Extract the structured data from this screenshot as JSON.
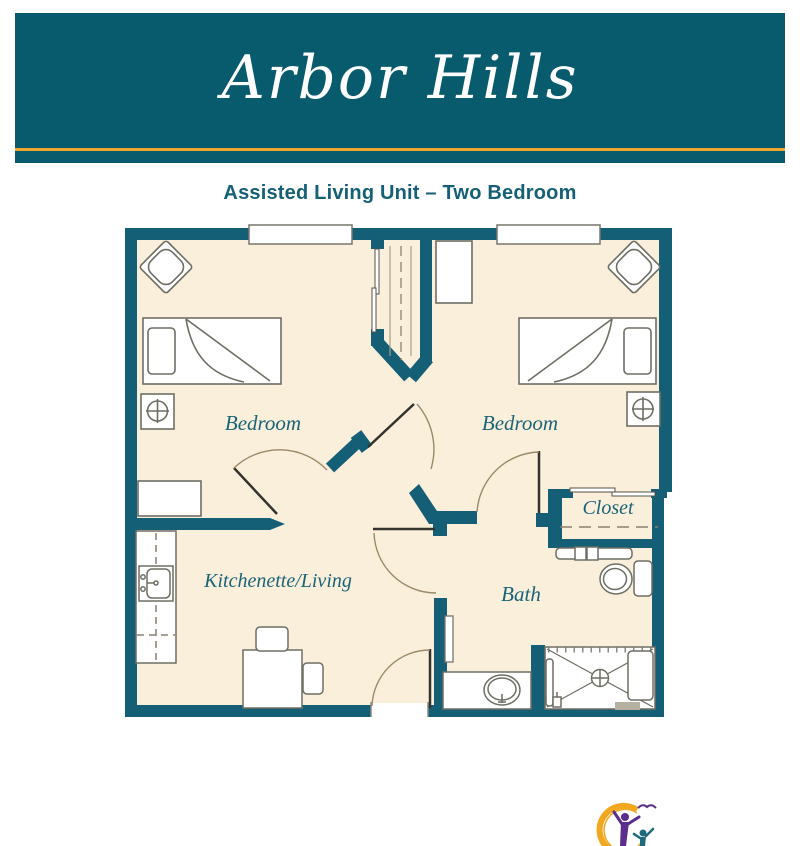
{
  "banner": {
    "title": "Arbor Hills"
  },
  "subtitle": "Assisted Living Unit – Two Bedroom",
  "rooms": {
    "bedroom_left": "Bedroom",
    "bedroom_right": "Bedroom",
    "kitchenette": "Kitchenette/Living",
    "bath": "Bath",
    "closet": "Closet"
  },
  "colors": {
    "banner_teal": "#085a6d",
    "wall_teal": "#155f76",
    "gold_accent": "#eea62e",
    "floor_cream": "#faefdb",
    "label_teal": "#1b6478",
    "logo_gold": "#f2a71f",
    "logo_purple": "#5b2d8f",
    "logo_teal": "#1f6a7d"
  },
  "symbols": [
    "window",
    "armchair",
    "twin-bed",
    "pillow",
    "blanket-fold",
    "nightstand-lamp",
    "dresser",
    "wardrobe",
    "sliding-door",
    "door-swing",
    "kitchen-counter",
    "kitchen-sink",
    "dining-table",
    "dining-chair",
    "closet-rod",
    "closet-shelf",
    "toilet",
    "vanity-sink",
    "shower",
    "shower-bench",
    "floor-drain",
    "patio-door"
  ],
  "logo": {
    "name": "arbor-hills-logo-mark"
  }
}
